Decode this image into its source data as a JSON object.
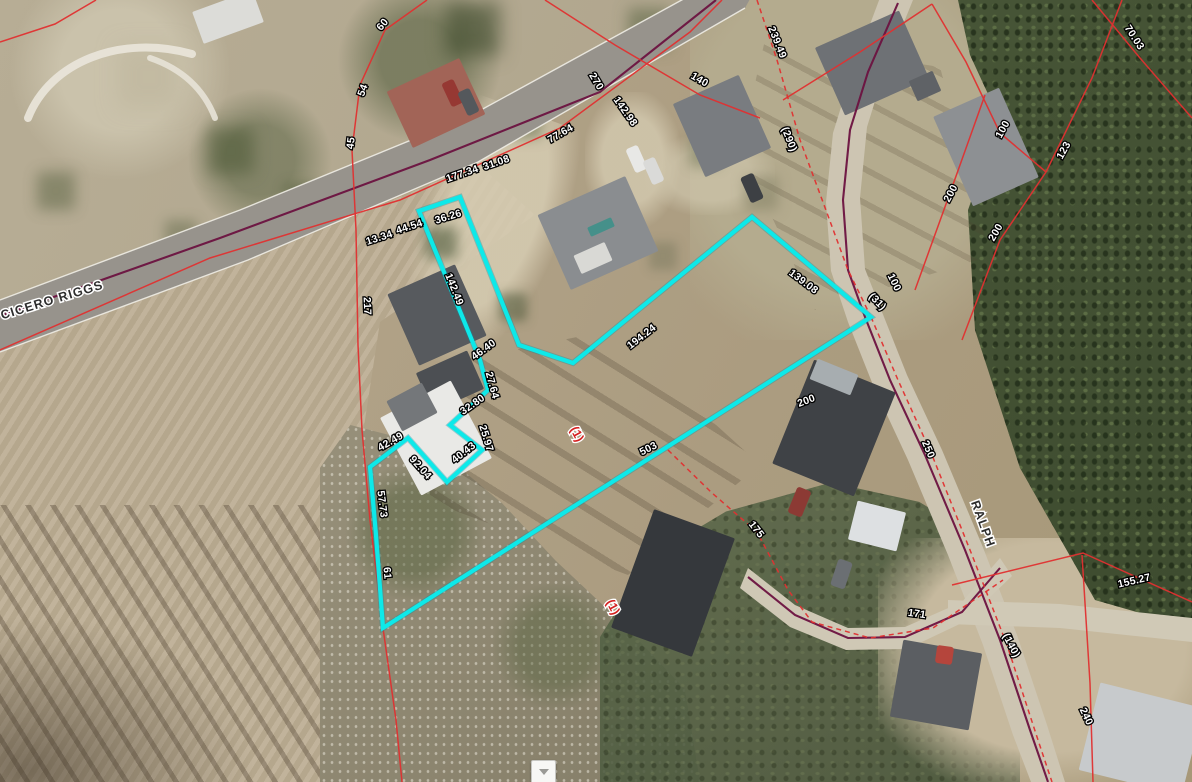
{
  "app": {
    "type": "gis-parcel-viewer-map"
  },
  "map": {
    "colors": {
      "selected_parcel": "#0de9e9",
      "parcel_line": "#e03030",
      "road_centerline": "#6b1240",
      "road_edge": "#efede5",
      "dimension_text": "#ffffff",
      "dimension_halo": "#000000",
      "street_text": "#2d2d2d",
      "street_halo": "#ffffff",
      "lot_text": "#d41f1f"
    },
    "streets": [
      {
        "name": "CICERO RIGGS",
        "x": 52,
        "y": 300,
        "rot": -17
      },
      {
        "name": "RALPH",
        "x": 983,
        "y": 524,
        "rot": 70
      }
    ],
    "lot_labels": [
      {
        "text": "(1)",
        "x": 577,
        "y": 434,
        "rot": 62
      },
      {
        "text": "(1)",
        "x": 613,
        "y": 607,
        "rot": 62
      }
    ],
    "dimension_labels": [
      {
        "text": "60",
        "x": 382,
        "y": 24,
        "rot": -50
      },
      {
        "text": "54",
        "x": 362,
        "y": 90,
        "rot": -70
      },
      {
        "text": "45",
        "x": 350,
        "y": 143,
        "rot": -83
      },
      {
        "text": "270",
        "x": 597,
        "y": 81,
        "rot": 59
      },
      {
        "text": "142.98",
        "x": 626,
        "y": 111,
        "rot": 55
      },
      {
        "text": "77.64",
        "x": 560,
        "y": 133,
        "rot": -30
      },
      {
        "text": "177.34",
        "x": 462,
        "y": 173,
        "rot": -19
      },
      {
        "text": "31.08",
        "x": 496,
        "y": 162,
        "rot": -19
      },
      {
        "text": "36.26",
        "x": 448,
        "y": 216,
        "rot": -17
      },
      {
        "text": "13.34",
        "x": 379,
        "y": 237,
        "rot": -18
      },
      {
        "text": "44.54",
        "x": 409,
        "y": 226,
        "rot": -18
      },
      {
        "text": "217",
        "x": 368,
        "y": 306,
        "rot": 88
      },
      {
        "text": "142.49",
        "x": 455,
        "y": 289,
        "rot": 68
      },
      {
        "text": "46.40",
        "x": 483,
        "y": 349,
        "rot": -36
      },
      {
        "text": "27.64",
        "x": 493,
        "y": 385,
        "rot": 75
      },
      {
        "text": "32.80",
        "x": 472,
        "y": 404,
        "rot": -35
      },
      {
        "text": "25.97",
        "x": 487,
        "y": 438,
        "rot": 73
      },
      {
        "text": "40.43",
        "x": 463,
        "y": 452,
        "rot": -38
      },
      {
        "text": "42.49",
        "x": 390,
        "y": 441,
        "rot": -30
      },
      {
        "text": "92.04",
        "x": 421,
        "y": 467,
        "rot": 48
      },
      {
        "text": "57.73",
        "x": 383,
        "y": 504,
        "rot": 83
      },
      {
        "text": "61",
        "x": 388,
        "y": 573,
        "rot": 85
      },
      {
        "text": "503",
        "x": 648,
        "y": 448,
        "rot": -27
      },
      {
        "text": "194.24",
        "x": 641,
        "y": 336,
        "rot": -38
      },
      {
        "text": "139.08",
        "x": 804,
        "y": 281,
        "rot": 37
      },
      {
        "text": "(31)",
        "x": 878,
        "y": 301,
        "rot": 45
      },
      {
        "text": "100",
        "x": 895,
        "y": 282,
        "rot": 64
      },
      {
        "text": "200",
        "x": 806,
        "y": 400,
        "rot": -21
      },
      {
        "text": "250",
        "x": 929,
        "y": 449,
        "rot": 67
      },
      {
        "text": "175",
        "x": 757,
        "y": 529,
        "rot": 52
      },
      {
        "text": "171",
        "x": 917,
        "y": 613,
        "rot": 8
      },
      {
        "text": "(140)",
        "x": 1012,
        "y": 645,
        "rot": 62
      },
      {
        "text": "155.27",
        "x": 1134,
        "y": 580,
        "rot": -13
      },
      {
        "text": "240",
        "x": 1087,
        "y": 716,
        "rot": 65
      },
      {
        "text": "239.49",
        "x": 778,
        "y": 42,
        "rot": 68
      },
      {
        "text": "(290)",
        "x": 790,
        "y": 139,
        "rot": 68
      },
      {
        "text": "140",
        "x": 700,
        "y": 79,
        "rot": 30
      },
      {
        "text": "70.03",
        "x": 1135,
        "y": 37,
        "rot": 57
      },
      {
        "text": "100",
        "x": 1002,
        "y": 129,
        "rot": -61
      },
      {
        "text": "123",
        "x": 1063,
        "y": 150,
        "rot": -61
      },
      {
        "text": "200",
        "x": 950,
        "y": 193,
        "rot": -62
      },
      {
        "text": "200",
        "x": 995,
        "y": 232,
        "rot": -60
      }
    ],
    "selected_parcel": {
      "points": [
        [
          419,
          211
        ],
        [
          460,
          197
        ],
        [
          519,
          345
        ],
        [
          573,
          363
        ],
        [
          752,
          217
        ],
        [
          871,
          317
        ],
        [
          383,
          628
        ],
        [
          376,
          535
        ],
        [
          370,
          467
        ],
        [
          408,
          438
        ],
        [
          447,
          482
        ],
        [
          482,
          450
        ],
        [
          450,
          425
        ],
        [
          488,
          390
        ],
        [
          480,
          360
        ]
      ]
    },
    "parcel_lines": [
      {
        "id": "boundary-along-cicero-riggs",
        "dash": false,
        "points": [
          [
            0,
            350
          ],
          [
            210,
            258
          ],
          [
            400,
            200
          ],
          [
            560,
            128
          ],
          [
            690,
            32
          ],
          [
            722,
            0
          ]
        ]
      },
      {
        "id": "boundary-northwest-corner",
        "dash": false,
        "points": [
          [
            0,
            42
          ],
          [
            55,
            24
          ],
          [
            96,
            0
          ]
        ]
      },
      {
        "id": "boundary-west-line",
        "dash": false,
        "points": [
          [
            427,
            0
          ],
          [
            385,
            30
          ],
          [
            360,
            85
          ],
          [
            352,
            150
          ],
          [
            356,
            230
          ],
          [
            358,
            345
          ],
          [
            362,
            430
          ],
          [
            370,
            520
          ],
          [
            383,
            628
          ],
          [
            396,
            720
          ],
          [
            402,
            782
          ]
        ]
      },
      {
        "id": "boundary-cross-road",
        "dash": false,
        "points": [
          [
            545,
            0
          ],
          [
            615,
            45
          ],
          [
            700,
            95
          ],
          [
            760,
            118
          ]
        ]
      },
      {
        "id": "boundary-lane-dashed",
        "dash": true,
        "points": [
          [
            757,
            0
          ],
          [
            777,
            60
          ],
          [
            800,
            140
          ],
          [
            827,
            213
          ],
          [
            848,
            270
          ],
          [
            871,
            317
          ]
        ]
      },
      {
        "id": "boundary-ralph-west-dashed",
        "dash": true,
        "points": [
          [
            871,
            317
          ],
          [
            898,
            380
          ],
          [
            932,
            455
          ],
          [
            972,
            555
          ],
          [
            1007,
            645
          ],
          [
            1038,
            740
          ],
          [
            1052,
            782
          ]
        ]
      },
      {
        "id": "boundary-northeast-1",
        "dash": false,
        "points": [
          [
            783,
            100
          ],
          [
            860,
            52
          ],
          [
            932,
            4
          ]
        ]
      },
      {
        "id": "boundary-northeast-2",
        "dash": false,
        "points": [
          [
            932,
            4
          ],
          [
            966,
            62
          ],
          [
            1000,
            133
          ],
          [
            1046,
            172
          ]
        ]
      },
      {
        "id": "boundary-northeast-3",
        "dash": false,
        "points": [
          [
            1046,
            172
          ],
          [
            1092,
            78
          ],
          [
            1122,
            0
          ]
        ]
      },
      {
        "id": "boundary-northeast-70",
        "dash": false,
        "points": [
          [
            1092,
            0
          ],
          [
            1140,
            58
          ],
          [
            1192,
            118
          ]
        ]
      },
      {
        "id": "boundary-forestside-a",
        "dash": false,
        "points": [
          [
            985,
            95
          ],
          [
            950,
            193
          ],
          [
            915,
            290
          ]
        ]
      },
      {
        "id": "boundary-forestside-b",
        "dash": false,
        "points": [
          [
            1046,
            172
          ],
          [
            1000,
            240
          ],
          [
            962,
            340
          ]
        ]
      },
      {
        "id": "boundary-south-dashed",
        "dash": true,
        "points": [
          [
            668,
            450
          ],
          [
            712,
            493
          ],
          [
            757,
            532
          ],
          [
            788,
            590
          ],
          [
            812,
            622
          ],
          [
            870,
            638
          ],
          [
            933,
            628
          ],
          [
            1003,
            580
          ]
        ]
      },
      {
        "id": "boundary-southeast-horizontal",
        "dash": false,
        "points": [
          [
            952,
            585
          ],
          [
            1083,
            553
          ],
          [
            1192,
            602
          ]
        ]
      },
      {
        "id": "boundary-southeast-vertical",
        "dash": false,
        "points": [
          [
            1082,
            555
          ],
          [
            1090,
            683
          ],
          [
            1093,
            782
          ]
        ]
      }
    ],
    "road_centerlines": [
      {
        "id": "cicero-riggs-centerline",
        "points": [
          [
            0,
            316
          ],
          [
            220,
            238
          ],
          [
            430,
            160
          ],
          [
            600,
            92
          ],
          [
            716,
            0
          ]
        ]
      },
      {
        "id": "ralph-centerline",
        "points": [
          [
            898,
            3
          ],
          [
            868,
            72
          ],
          [
            850,
            130
          ],
          [
            843,
            200
          ],
          [
            848,
            270
          ],
          [
            865,
            317
          ],
          [
            890,
            380
          ],
          [
            925,
            455
          ],
          [
            965,
            550
          ],
          [
            1000,
            640
          ],
          [
            1030,
            730
          ],
          [
            1048,
            782
          ]
        ]
      },
      {
        "id": "ralph-spur-centerline",
        "points": [
          [
            1000,
            568
          ],
          [
            962,
            612
          ],
          [
            905,
            637
          ],
          [
            848,
            638
          ],
          [
            795,
            615
          ],
          [
            748,
            577
          ]
        ]
      }
    ],
    "roads": [
      {
        "id": "cicero-riggs-pavement",
        "fill": "#97938c",
        "points": [
          [
            0,
            300
          ],
          [
            240,
            210
          ],
          [
            470,
            116
          ],
          [
            700,
            -10
          ],
          [
            755,
            -10
          ],
          [
            745,
            8
          ],
          [
            478,
            162
          ],
          [
            248,
            260
          ],
          [
            0,
            352
          ]
        ]
      },
      {
        "id": "ralph-gravel-lane",
        "fill": "#cdc5b2",
        "points": [
          [
            881,
            -5
          ],
          [
            851,
            75
          ],
          [
            833,
            133
          ],
          [
            826,
            202
          ],
          [
            831,
            271
          ],
          [
            848,
            322
          ],
          [
            873,
            385
          ],
          [
            908,
            460
          ],
          [
            948,
            555
          ],
          [
            983,
            645
          ],
          [
            1013,
            735
          ],
          [
            1031,
            782
          ],
          [
            1065,
            782
          ],
          [
            1047,
            725
          ],
          [
            1017,
            635
          ],
          [
            982,
            545
          ],
          [
            942,
            450
          ],
          [
            907,
            375
          ],
          [
            882,
            312
          ],
          [
            865,
            269
          ],
          [
            860,
            198
          ],
          [
            867,
            127
          ],
          [
            885,
            69
          ],
          [
            915,
            -5
          ]
        ]
      },
      {
        "id": "ralph-spur-gravel",
        "fill": "#cfc8b5",
        "points": [
          [
            748,
            568
          ],
          [
            795,
            605
          ],
          [
            848,
            628
          ],
          [
            905,
            627
          ],
          [
            962,
            602
          ],
          [
            1000,
            558
          ],
          [
            1012,
            576
          ],
          [
            964,
            622
          ],
          [
            907,
            649
          ],
          [
            846,
            650
          ],
          [
            790,
            627
          ],
          [
            740,
            588
          ]
        ]
      },
      {
        "id": "southeast-driveway",
        "fill": "#d0c9b6",
        "points": [
          [
            948,
            600
          ],
          [
            1060,
            604
          ],
          [
            1192,
            618
          ],
          [
            1192,
            642
          ],
          [
            1060,
            628
          ],
          [
            948,
            624
          ]
        ]
      }
    ],
    "road_edges": [
      [
        [
          0,
          300
        ],
        [
          240,
          210
        ],
        [
          470,
          116
        ],
        [
          700,
          -10
        ]
      ],
      [
        [
          0,
          352
        ],
        [
          248,
          260
        ],
        [
          478,
          162
        ],
        [
          745,
          8
        ]
      ]
    ],
    "terrain_paths": [
      {
        "d": "M28,118 C50,62 120,34 192,54",
        "stroke": "#e9e5da",
        "w": 8
      },
      {
        "d": "M150,58 C185,70 205,92 215,118",
        "stroke": "#e6e2d6",
        "w": 6
      }
    ],
    "buildings": [
      [
        196,
        0,
        64,
        34,
        -20,
        "#dcdcd8"
      ],
      [
        396,
        72,
        80,
        62,
        -25,
        "#a26457"
      ],
      [
        550,
        192,
        96,
        82,
        -24,
        "#8a8d90"
      ],
      [
        588,
        222,
        26,
        10,
        -24,
        "#45908a"
      ],
      [
        576,
        248,
        34,
        20,
        -24,
        "#d9d9d5"
      ],
      [
        686,
        86,
        72,
        80,
        -24,
        "#797c80"
      ],
      [
        826,
        26,
        92,
        74,
        -24,
        "#6e7175"
      ],
      [
        912,
        75,
        26,
        22,
        -24,
        "#5f6266"
      ],
      [
        950,
        98,
        72,
        98,
        -24,
        "#8d9093"
      ],
      [
        400,
        276,
        74,
        78,
        -24,
        "#575a5e"
      ],
      [
        422,
        360,
        56,
        42,
        -24,
        "#4c4f53"
      ],
      [
        396,
        394,
        80,
        88,
        -28,
        "#e9e9e6"
      ],
      [
        392,
        390,
        40,
        34,
        -28,
        "#74777a"
      ],
      [
        790,
        372,
        88,
        112,
        22,
        "#3f4246"
      ],
      [
        812,
        366,
        44,
        22,
        22,
        "#a7adb0"
      ],
      [
        852,
        506,
        50,
        40,
        14,
        "#dde0e2"
      ],
      [
        630,
        520,
        86,
        126,
        20,
        "#35383c"
      ],
      [
        896,
        646,
        80,
        78,
        10,
        "#5b5e62"
      ],
      [
        1088,
        694,
        106,
        90,
        14,
        "#c7cacc"
      ]
    ],
    "cars": [
      [
        446,
        80,
        13,
        26,
        -25,
        "#963833"
      ],
      [
        462,
        89,
        13,
        26,
        -25,
        "#54585c"
      ],
      [
        630,
        146,
        13,
        26,
        -24,
        "#e8e8e6"
      ],
      [
        647,
        158,
        13,
        26,
        -24,
        "#dadad8"
      ],
      [
        745,
        174,
        14,
        28,
        -24,
        "#3d4044"
      ],
      [
        792,
        488,
        15,
        28,
        22,
        "#8c3a34"
      ],
      [
        834,
        560,
        15,
        28,
        18,
        "#6b6f73"
      ],
      [
        936,
        646,
        17,
        18,
        8,
        "#b5453c"
      ]
    ]
  },
  "ui": {
    "collapse_button": {
      "icon": "chevron-down"
    }
  }
}
